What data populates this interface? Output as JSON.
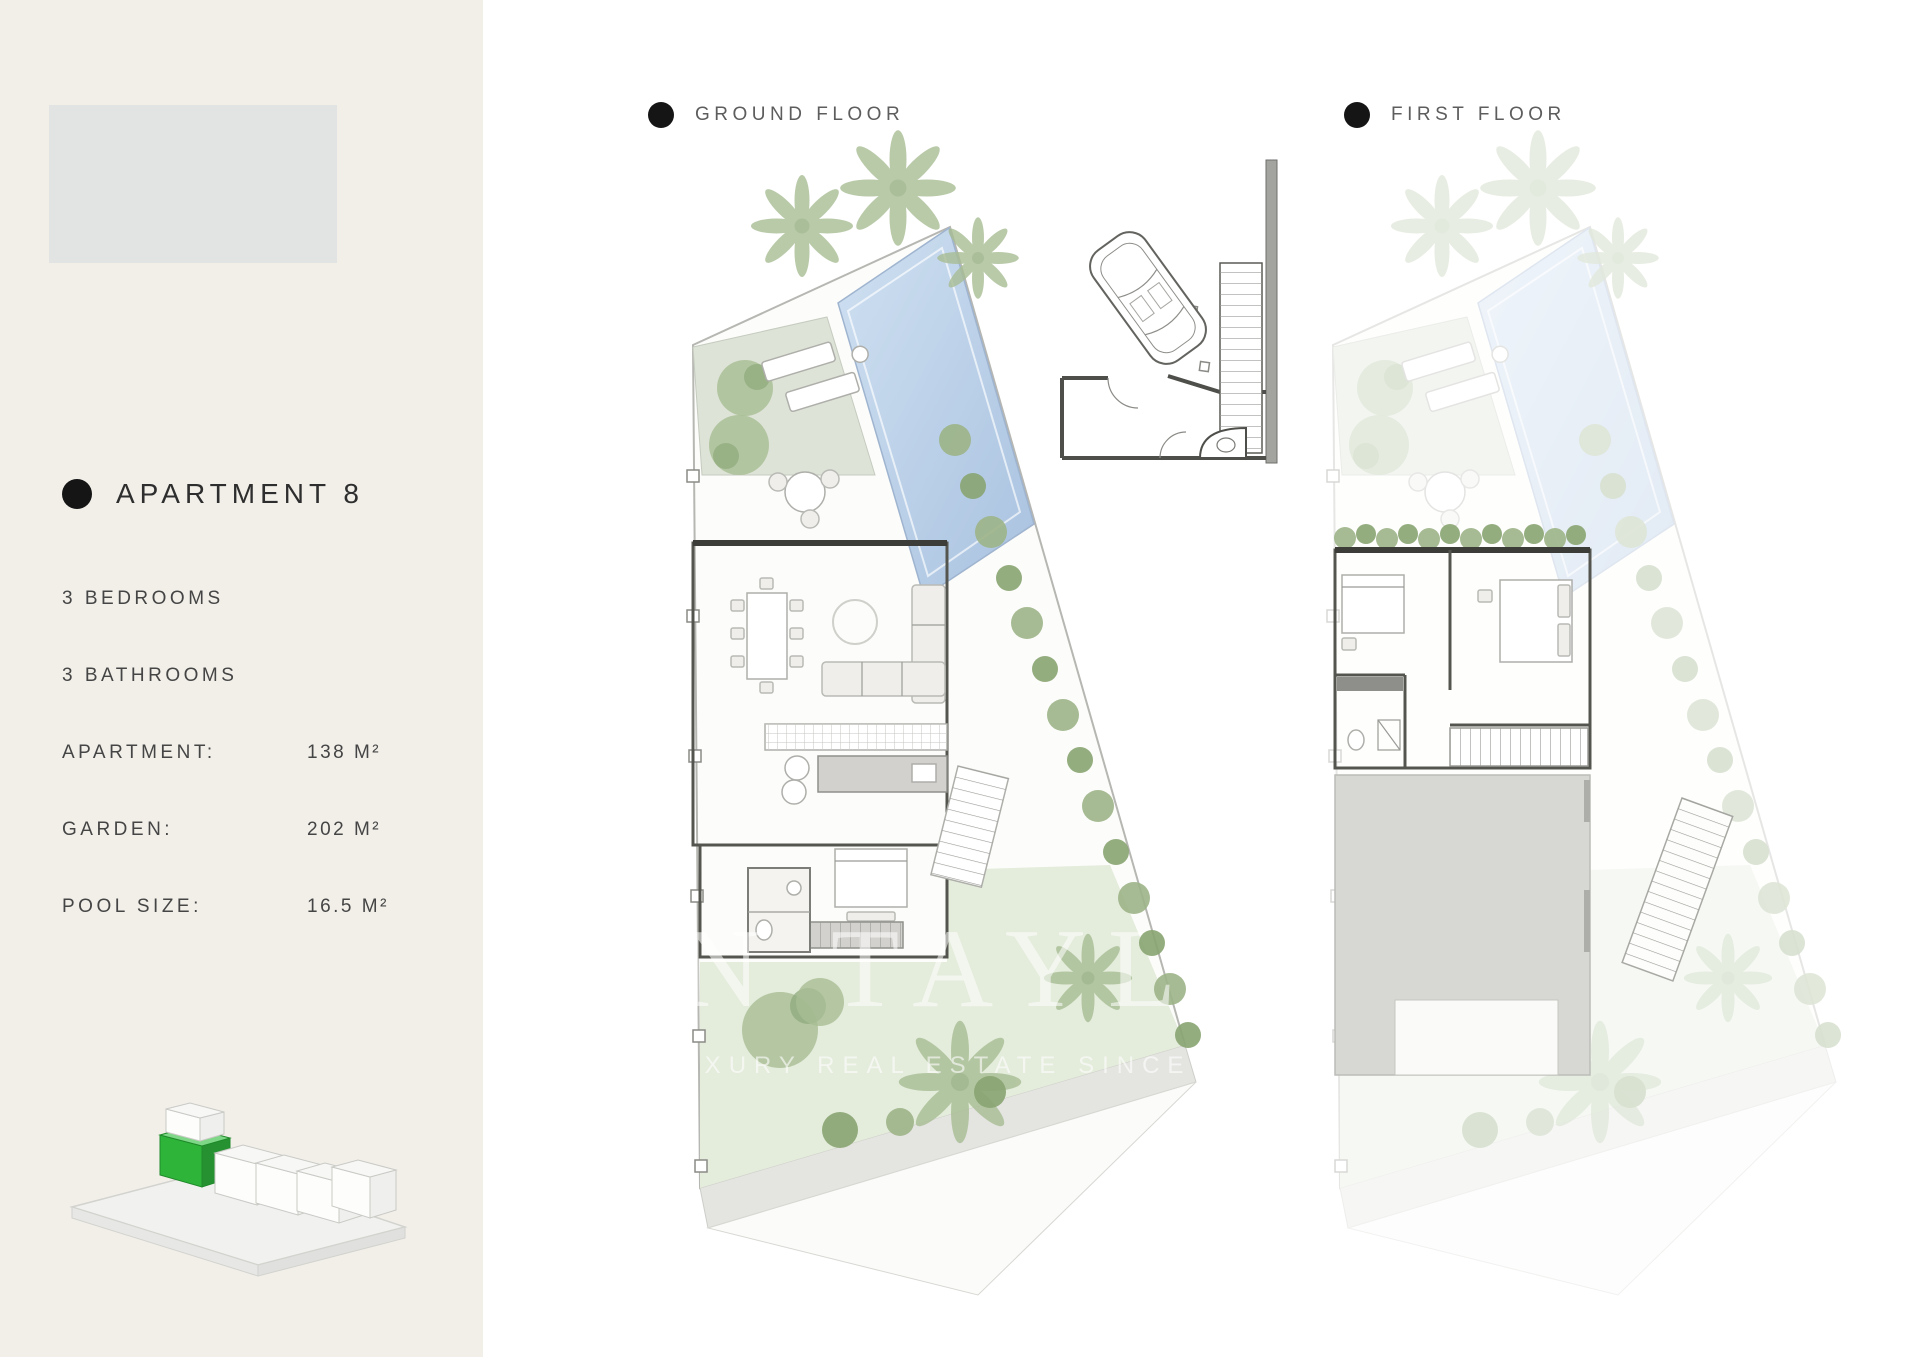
{
  "sidebar": {
    "apartment_title": "APARTMENT 8",
    "specs": [
      {
        "label": "3 BEDROOMS",
        "value": ""
      },
      {
        "label": "3 BATHROOMS",
        "value": ""
      },
      {
        "label": "APARTMENT:",
        "value": "138 M²"
      },
      {
        "label": "GARDEN:",
        "value": "202 M²"
      },
      {
        "label": "POOL SIZE:",
        "value": "16.5 M²"
      }
    ]
  },
  "plans": {
    "ground_floor_label": "GROUND FLOOR",
    "first_floor_label": "FIRST FLOOR"
  },
  "watermark": {
    "brand_fragment": "N TAYL",
    "tagline_fragment": "LUXURY REAL ESTATE SINCE 19"
  },
  "colors": {
    "sidebar-bg": "#f2efe9",
    "placeholder-gray": "#e2e3e3",
    "bullet": "#151515",
    "text-dark": "#3f3f3f",
    "pool-blue": "#c9dcf0",
    "pool-blue-deep": "#aac3e2",
    "terrace-green": "#dde3d6",
    "garden-green": "#e4ecdb",
    "foliage": "#a8bd94",
    "foliage-dark": "#8fa97c",
    "hedge": "#95af82",
    "roof-gray": "#d7d7d4",
    "accent-green": "#2fb43a"
  }
}
